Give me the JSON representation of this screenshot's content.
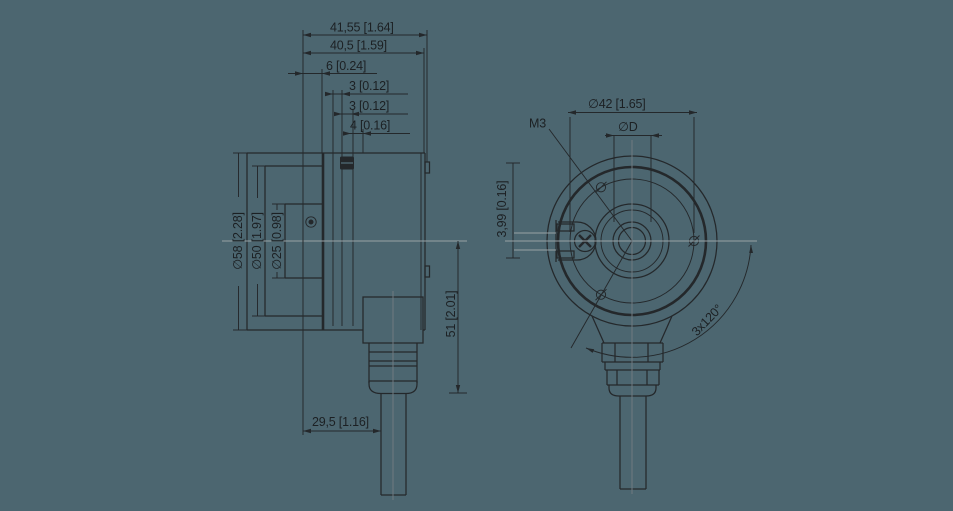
{
  "drawing": {
    "background": "#4c6670",
    "ink_color": "#24282b",
    "centerline_color": "#97a1a5",
    "side_view": {
      "dim_total_depth": "41,55 [1.64]",
      "dim_body_depth": "40,5 [1.59]",
      "dim_front_offset": "6 [0.24]",
      "dim_step_a": "3 [0.12]",
      "dim_step_b": "3 [0.12]",
      "dim_step_c": "4 [0.16]",
      "dim_flange_diameter": "∅58 [2.28]",
      "dim_pilot_diameter": "∅50 [1.97]",
      "dim_boss_diameter": "∅25 [0.98]",
      "dim_gland_length": "51 [2.01]",
      "dim_cable_offset": "29,5 [1.16]"
    },
    "front_view": {
      "dim_bolt_circle": "∅42 [1.65]",
      "dim_shaft_bore": "∅D",
      "label_screw_thread": "M3",
      "dim_tab_thickness": "3,99 [0.16]",
      "label_hole_pattern": "3x120°"
    }
  }
}
